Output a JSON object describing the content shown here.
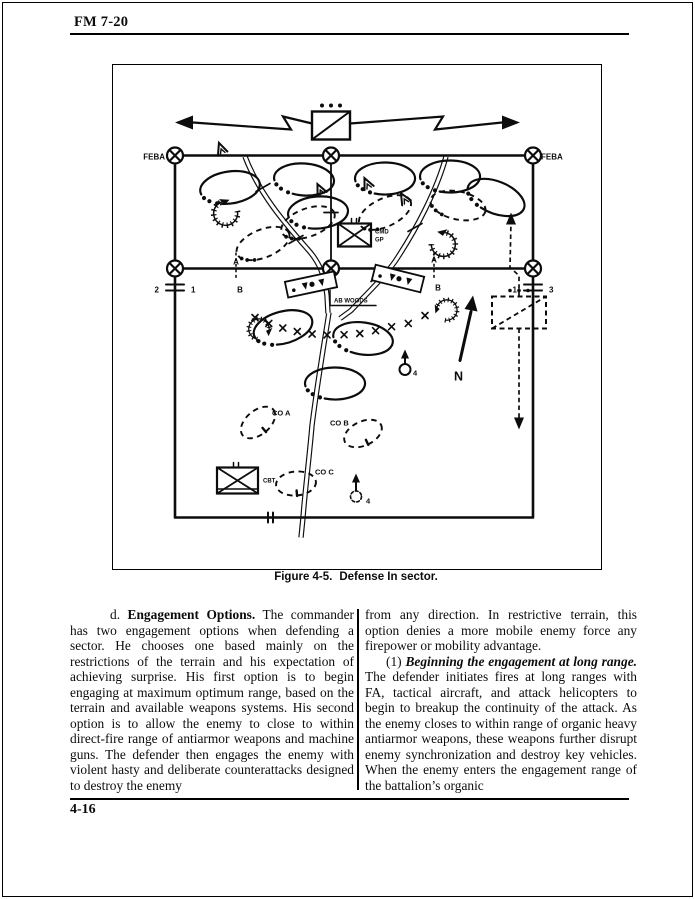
{
  "header": {
    "doc_id": "FM 7-20"
  },
  "figure": {
    "caption_label": "Figure 4-5.",
    "caption_text": "Defense In sector.",
    "labels": {
      "feba_left": "FEBA",
      "feba_right": "FEBA",
      "cmd": "CMD",
      "gp": "GP",
      "ab_woods": "AB WOODS",
      "co_a": "CO A",
      "co_b": "CO B",
      "co_c": "CO C",
      "cbt": "CBT",
      "north": "N",
      "left_bdry_left": "2",
      "left_bdry_right": "1",
      "right_bdry_left": "1",
      "right_bdry_right": "3",
      "ab_left_a": "A",
      "ab_left_b": "B",
      "ab_right_a": "A",
      "ab_right_b": "B",
      "cp_upper": "4",
      "cp_lower": "4"
    }
  },
  "body": {
    "left_column": {
      "para_prefix": "d. ",
      "para_lead": "Engagement Options.",
      "para_rest": " The commander has two engagement options when defending a sector. He chooses one based mainly on the restrictions of the terrain and his expectation of achieving surprise. His first option is to begin engaging at maximum optimum range, based on the terrain and available weapons systems. His second option is to allow the enemy to close to within direct-fire range of antiarmor weapons and machine guns. The defender then engages the enemy with violent hasty and deliberate counterattacks designed to destroy the enemy"
    },
    "right_column": {
      "para1": "from any direction. In restrictive terrain, this option denies a more mobile enemy force any firepower or mobility advantage.",
      "para2_prefix": "(1) ",
      "para2_lead": "Beginning the engagement at long range.",
      "para2_rest": " The defender initiates fires at long ranges with FA, tactical aircraft, and attack helicopters to begin to breakup the continuity of the attack. As the enemy closes to within range of organic heavy antiarmor weapons, these weapons further disrupt enemy synchronization and destroy key vehicles. When the enemy enters the engagement range of the battalion’s organic"
    }
  },
  "footer": {
    "page_number": "4-16"
  }
}
